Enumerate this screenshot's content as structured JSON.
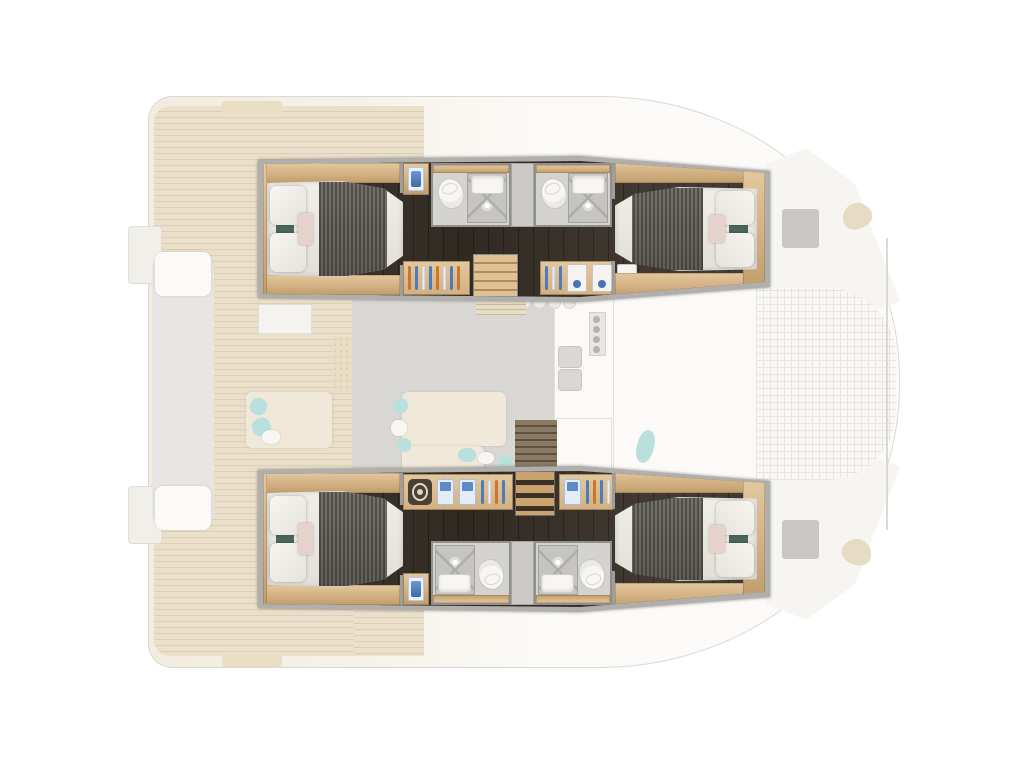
{
  "scene": {
    "type": "catamaran-deck-plan",
    "view": "top-down floor plan",
    "description": "Catamaran yacht layout: four double cabins with ensuite bathrooms and wardrobes highlighted in the two hulls; saloon, galley, aft cockpit and bow trampoline shown faded"
  },
  "labels": {
    "deck_plan": "Catamaran deck plan",
    "port_hull": "Port hull (highlighted)",
    "starboard_hull": "Starboard hull (highlighted)",
    "aft_cabin": "Aft double cabin",
    "forward_cabin": "Forward double cabin",
    "bed": "Double berth with grey blanket and pillows",
    "bathroom": "Bathroom with toilet, washbasin and shower",
    "toilet": "Toilet",
    "shower": "Shower tray",
    "washbasin": "Washbasin",
    "vanity": "Washbasin cabinet",
    "wardrobe": "Wardrobe with hanging clothes",
    "drawers": "Shelved shirts with blue handles",
    "helm_wheel": "Ship wheel emblem",
    "staircase": "Companionway stairs",
    "saloon": "Saloon (faded)",
    "galley": "Galley with sink and stove (faded)",
    "aft_deck": "Aft cockpit teak deck (faded)",
    "stern_bench": "Cockpit bench (faded)",
    "trampoline": "Bow trampoline (faded)",
    "bow_hatch": "Deck hatch (faded)",
    "chaise": "Deck lounger (faded)",
    "sofa": "Saloon sofa (faded)",
    "rattan_table": "Rattan coffee table (faded)",
    "nav_desk": "Chart table (faded)",
    "bar_stool": "Bar stool (faded)"
  },
  "colors": {
    "bg": "#ffffff",
    "wall": "#b0afac",
    "wall_edge": "#6f6f6d",
    "floor_dark": "#383027",
    "wood_light": "#e3c89e",
    "wood_mid": "#d2b082",
    "wood_dark": "#c09d6d",
    "bed_white": "#f0eee8",
    "duvet_gray": "#585550",
    "pillow_teal": "#4d675d",
    "pillow_blush": "#e6d2cc",
    "bath_floor": "#d4d3d0",
    "bath_wall": "#8f8f8d",
    "shower_gray": "#c5c4c1",
    "fixture_white": "#f7f6f3",
    "divider_gray": "#cbcac7",
    "sink_blue": "#3f68a8",
    "sink_blue_light": "#e8f0f9",
    "hanger_blue": "#4e7cb8",
    "hanger_orange": "#c7772f",
    "drawer_knob": "#4873b4",
    "wheel_dark": "#4a4034",
    "wheel_ring": "#ded6c6",
    "ghost_deck": "#eadfca",
    "ghost_deck_line": "#ddcfb4",
    "ghost_outline": "#dbd9d4",
    "ghost_white": "#fbfaf8",
    "ghost_gray": "#d9d7d3",
    "ghost_sofa": "#f0e9d9",
    "ghost_teal": "#b9e0dc",
    "ghost_hatch": "#c8c7c4",
    "ghost_bench": "#e6e5e2",
    "ghost_grid": "#e7e5e0"
  },
  "inventory": {
    "cabins": 4,
    "bathrooms": 4,
    "showers": 4,
    "staircases": 2,
    "wardrobes": 4
  }
}
